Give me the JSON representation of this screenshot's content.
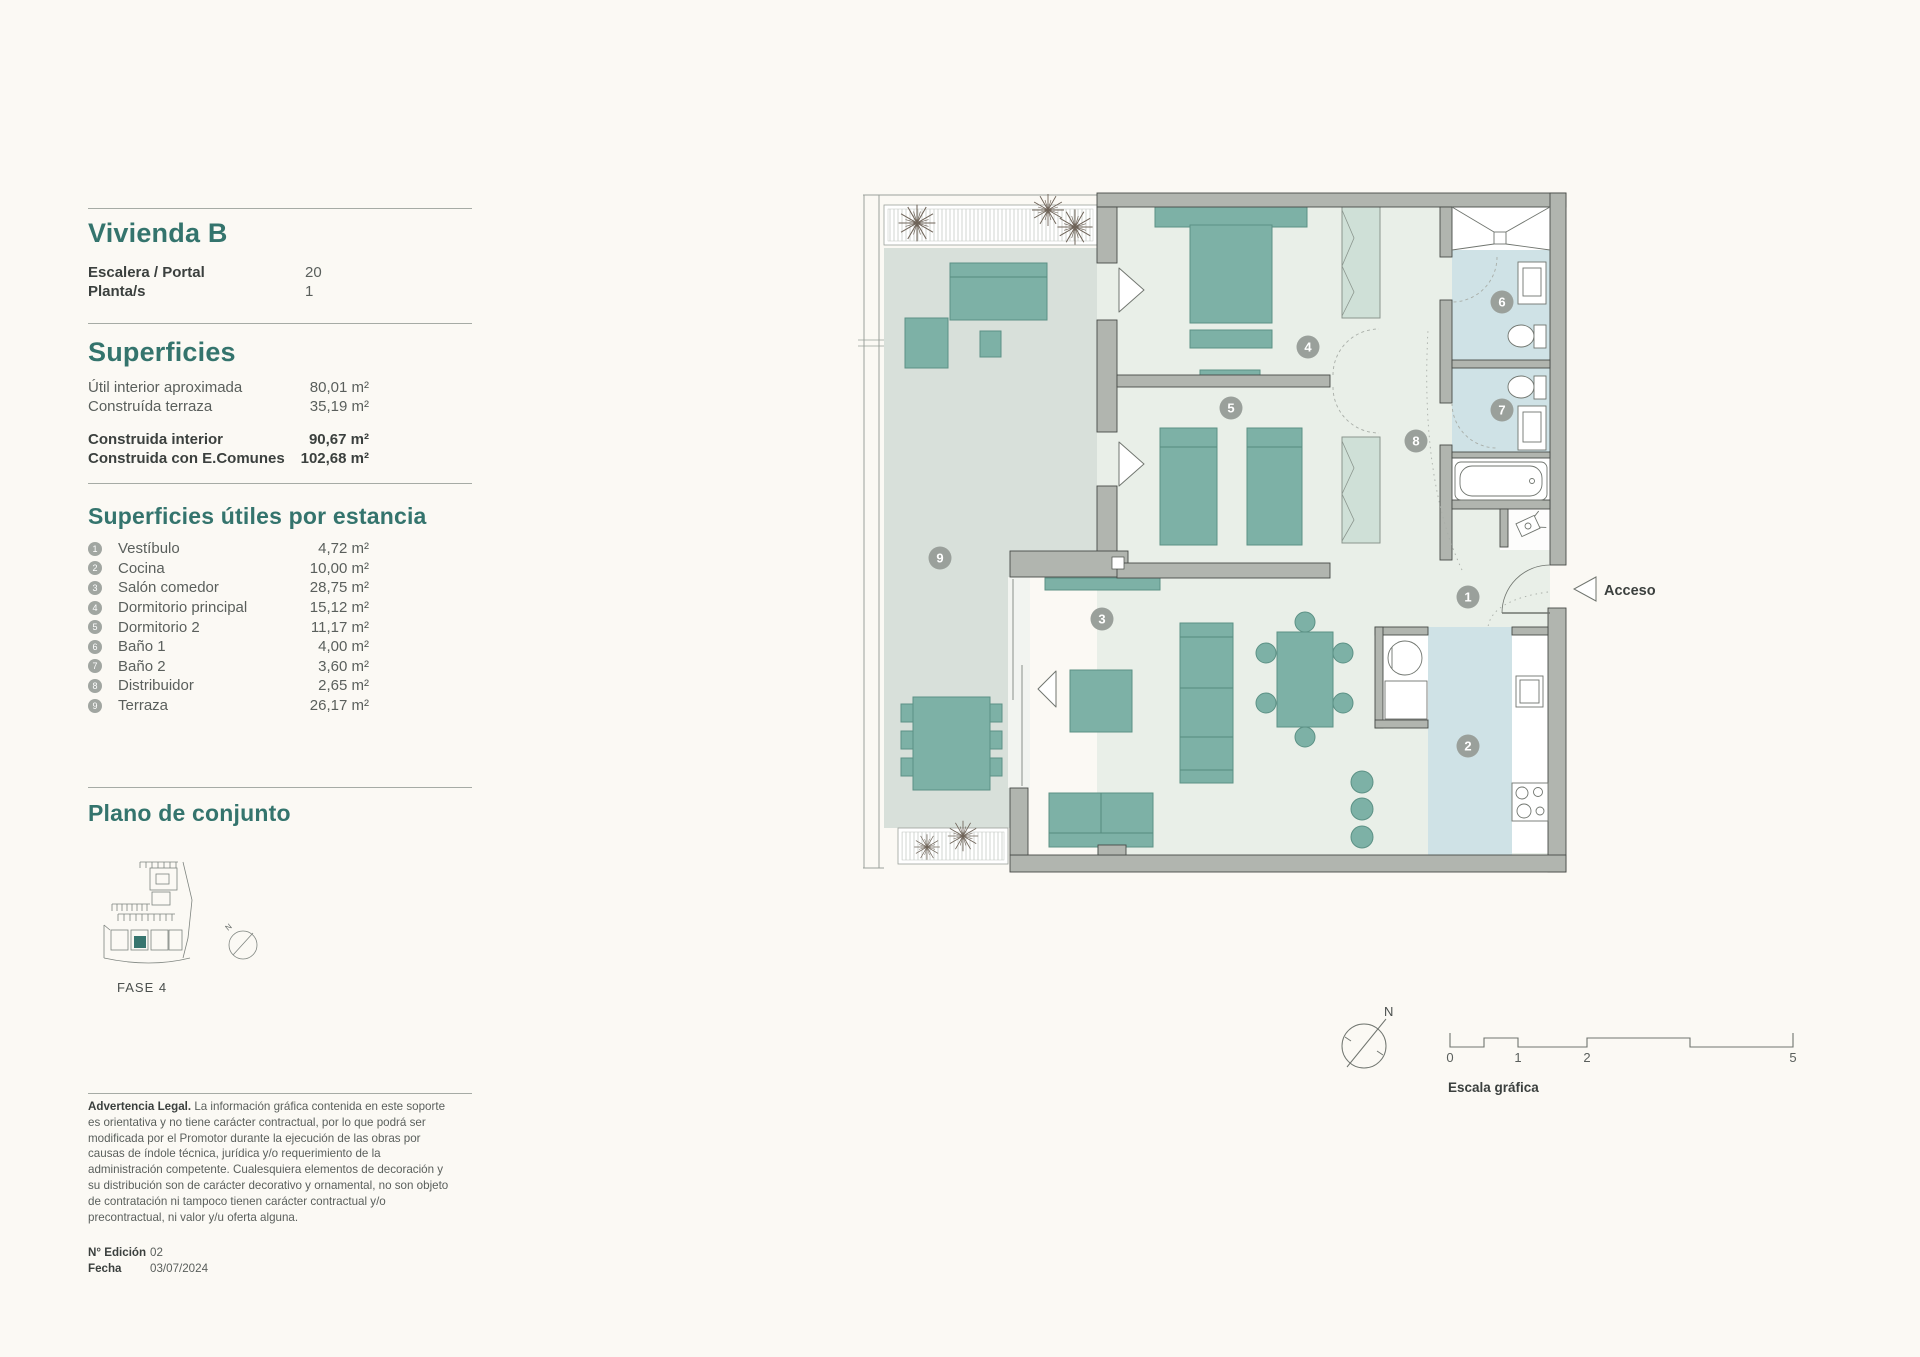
{
  "sidebar": {
    "title": "Vivienda B",
    "info": [
      {
        "label": "Escalera / Portal",
        "value": "20"
      },
      {
        "label": "Planta/s",
        "value": "1"
      }
    ],
    "surfaces": {
      "heading": "Superficies",
      "rows": [
        {
          "label": "Útil interior aproximada",
          "value": "80,01 m²"
        },
        {
          "label": "Construída terraza",
          "value": "35,19 m²"
        }
      ],
      "bold_rows": [
        {
          "label": "Construida interior",
          "value": "90,67 m²"
        },
        {
          "label": "Construida con E.Comunes",
          "value": "102,68 m²"
        }
      ]
    },
    "rooms": {
      "heading": "Superficies útiles por estancia",
      "items": [
        {
          "num": "1",
          "label": "Vestíbulo",
          "value": "4,72 m²"
        },
        {
          "num": "2",
          "label": "Cocina",
          "value": "10,00 m²"
        },
        {
          "num": "3",
          "label": "Salón comedor",
          "value": "28,75 m²"
        },
        {
          "num": "4",
          "label": "Dormitorio principal",
          "value": "15,12 m²"
        },
        {
          "num": "5",
          "label": "Dormitorio 2",
          "value": "11,17 m²"
        },
        {
          "num": "6",
          "label": "Baño 1",
          "value": "4,00 m²"
        },
        {
          "num": "7",
          "label": "Baño 2",
          "value": "3,60 m²"
        },
        {
          "num": "8",
          "label": "Distribuidor",
          "value": "2,65 m²"
        },
        {
          "num": "9",
          "label": "Terraza",
          "value": "26,17 m²"
        }
      ]
    },
    "site_plan": {
      "heading": "Plano de conjunto",
      "phase_label": "FASE 4",
      "compass_label": "N"
    },
    "legal": {
      "bold": "Advertencia Legal.",
      "text": " La información gráfica contenida en este soporte es orientativa y no tiene carácter contractual, por lo que podrá ser modificada por el Promotor durante la ejecución de las obras por causas de índole técnica, jurídica y/o requerimiento de la administración competente. Cualesquiera elementos de decoración y su distribución son de carácter decorativo y ornamental, no son objeto de contratación ni tampoco tienen carácter contractual y/o precontractual, ni valor y/u oferta alguna."
    },
    "edition": [
      {
        "label": "N° Edición",
        "value": "02"
      },
      {
        "label": "Fecha",
        "value": "03/07/2024"
      }
    ]
  },
  "plan": {
    "access_label": "Acceso",
    "compass_label": "N",
    "markers": [
      {
        "n": "1"
      },
      {
        "n": "2"
      },
      {
        "n": "3"
      },
      {
        "n": "4"
      },
      {
        "n": "5"
      },
      {
        "n": "6"
      },
      {
        "n": "7"
      },
      {
        "n": "8"
      },
      {
        "n": "9"
      }
    ],
    "scale": {
      "title": "Escala gráfica",
      "ticks": [
        "0",
        "1",
        "2",
        "5"
      ]
    }
  },
  "colors": {
    "accent": "#34746d",
    "furniture_teal": "#7db1a6",
    "wall_gray": "#b1b5af",
    "terrace_floor": "#d8e0da",
    "interior_floor": "#e9efe8",
    "wet_blue": "#cfe2e6",
    "marker_gray": "#9aa09b"
  }
}
